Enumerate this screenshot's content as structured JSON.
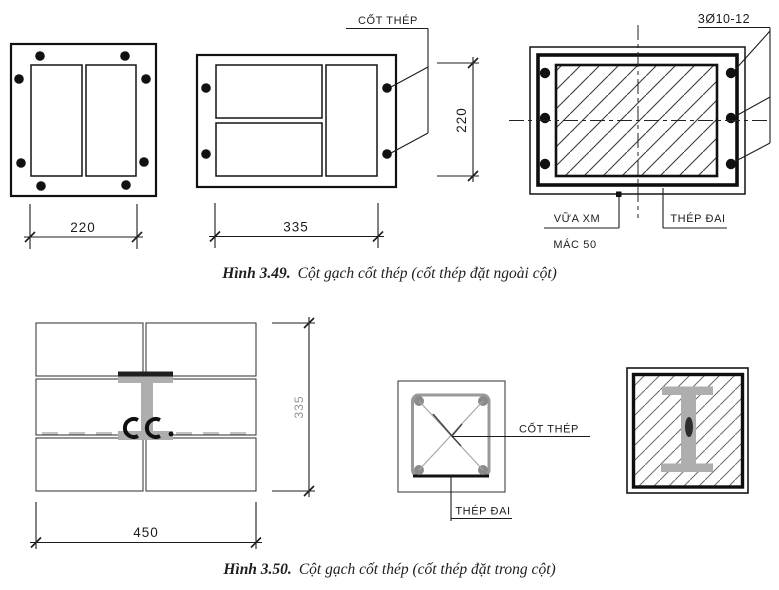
{
  "figure_349": {
    "caption_label": "Hình 3.49.",
    "caption_text": "Cột gạch cốt thép (cốt thép đặt ngoài cột)",
    "square_section": {
      "width_dim": "220"
    },
    "wide_section": {
      "width_dim": "335",
      "rebar_label": "CỐT THÉP"
    },
    "detail_section": {
      "rebar_spec": "3Ø10-12",
      "height_dim": "220",
      "mortar_label_line1": "VỮA XM",
      "mortar_label_line2": "MÁC 50",
      "stirrup_label": "THÉP ĐAI"
    }
  },
  "figure_350": {
    "caption_label": "Hình 3.50.",
    "caption_text": "Cột gạch cốt thép (cốt thép đặt trong cột)",
    "masonry_plan": {
      "height_dim": "335",
      "width_dim": "450"
    },
    "tie_section": {
      "rebar_label": "CỐT THÉP",
      "stirrup_label": "THÉP ĐAI"
    },
    "ibeam_section": {}
  },
  "colors": {
    "line": "#1c1c1c",
    "steel": "#aeaeae",
    "steel_dark": "#1f1f1f",
    "dim_gray_text": "#949494"
  }
}
